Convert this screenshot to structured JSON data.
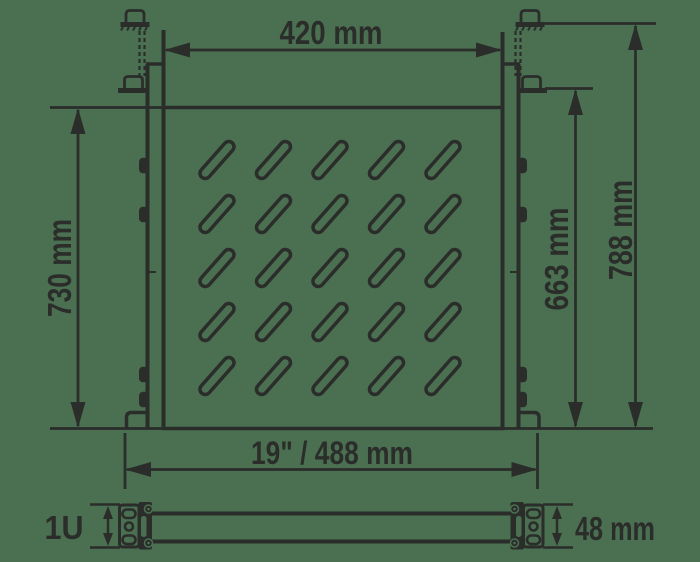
{
  "diagram": {
    "type": "rack-shelf-dimension-drawing",
    "views": [
      "front-view",
      "side-profile-view"
    ],
    "vent_slots": {
      "rows": 5,
      "columns": 5,
      "shape": "diagonal-slot"
    }
  },
  "labels": {
    "top_width": "420 mm",
    "left_height": "730 mm",
    "right_inner_height": "663 mm",
    "right_outer_height": "788 mm",
    "bottom_width": "19\" / 488 mm",
    "rack_units": "1U",
    "profile_height": "48 mm"
  },
  "colors": {
    "line": "#2b2d2b",
    "background": "#4a7051"
  }
}
